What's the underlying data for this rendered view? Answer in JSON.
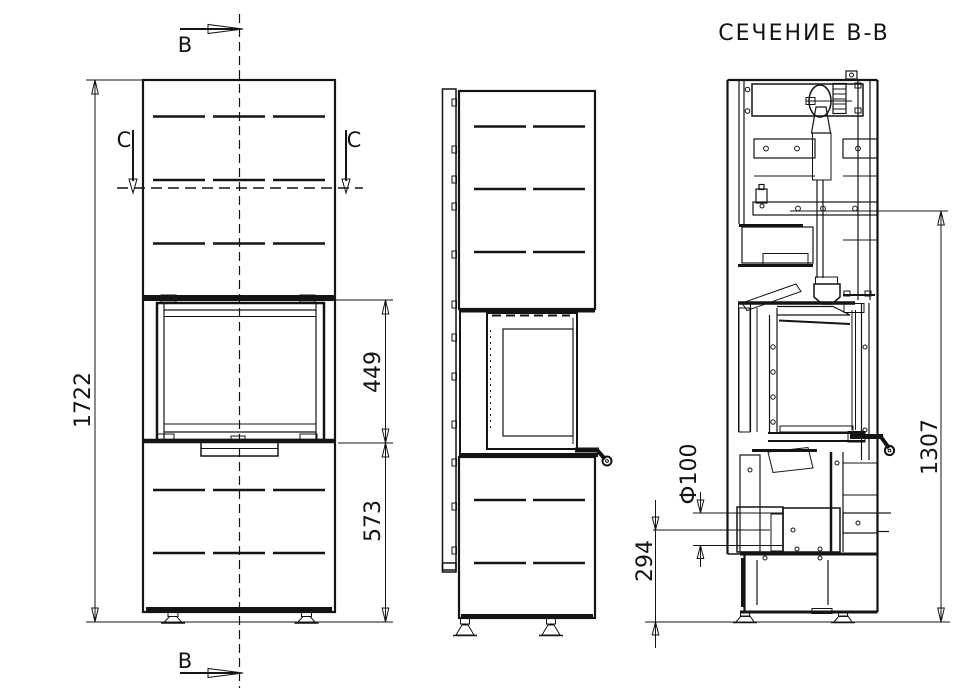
{
  "drawing": {
    "title": "СЕЧЕНИЕ B-B",
    "labels": {
      "section_b_top": "B",
      "section_b_bottom": "B",
      "section_c_left": "C",
      "section_c_right": "C"
    },
    "dimensions": {
      "overall_height": "1722",
      "firebox_opening_height": "449",
      "pedestal_height": "573",
      "flue_diameter": "Ф100",
      "flue_axis_height": "294",
      "flue_connector_height": "1307"
    },
    "colors": {
      "line": "#141414",
      "background": "#ffffff"
    }
  }
}
